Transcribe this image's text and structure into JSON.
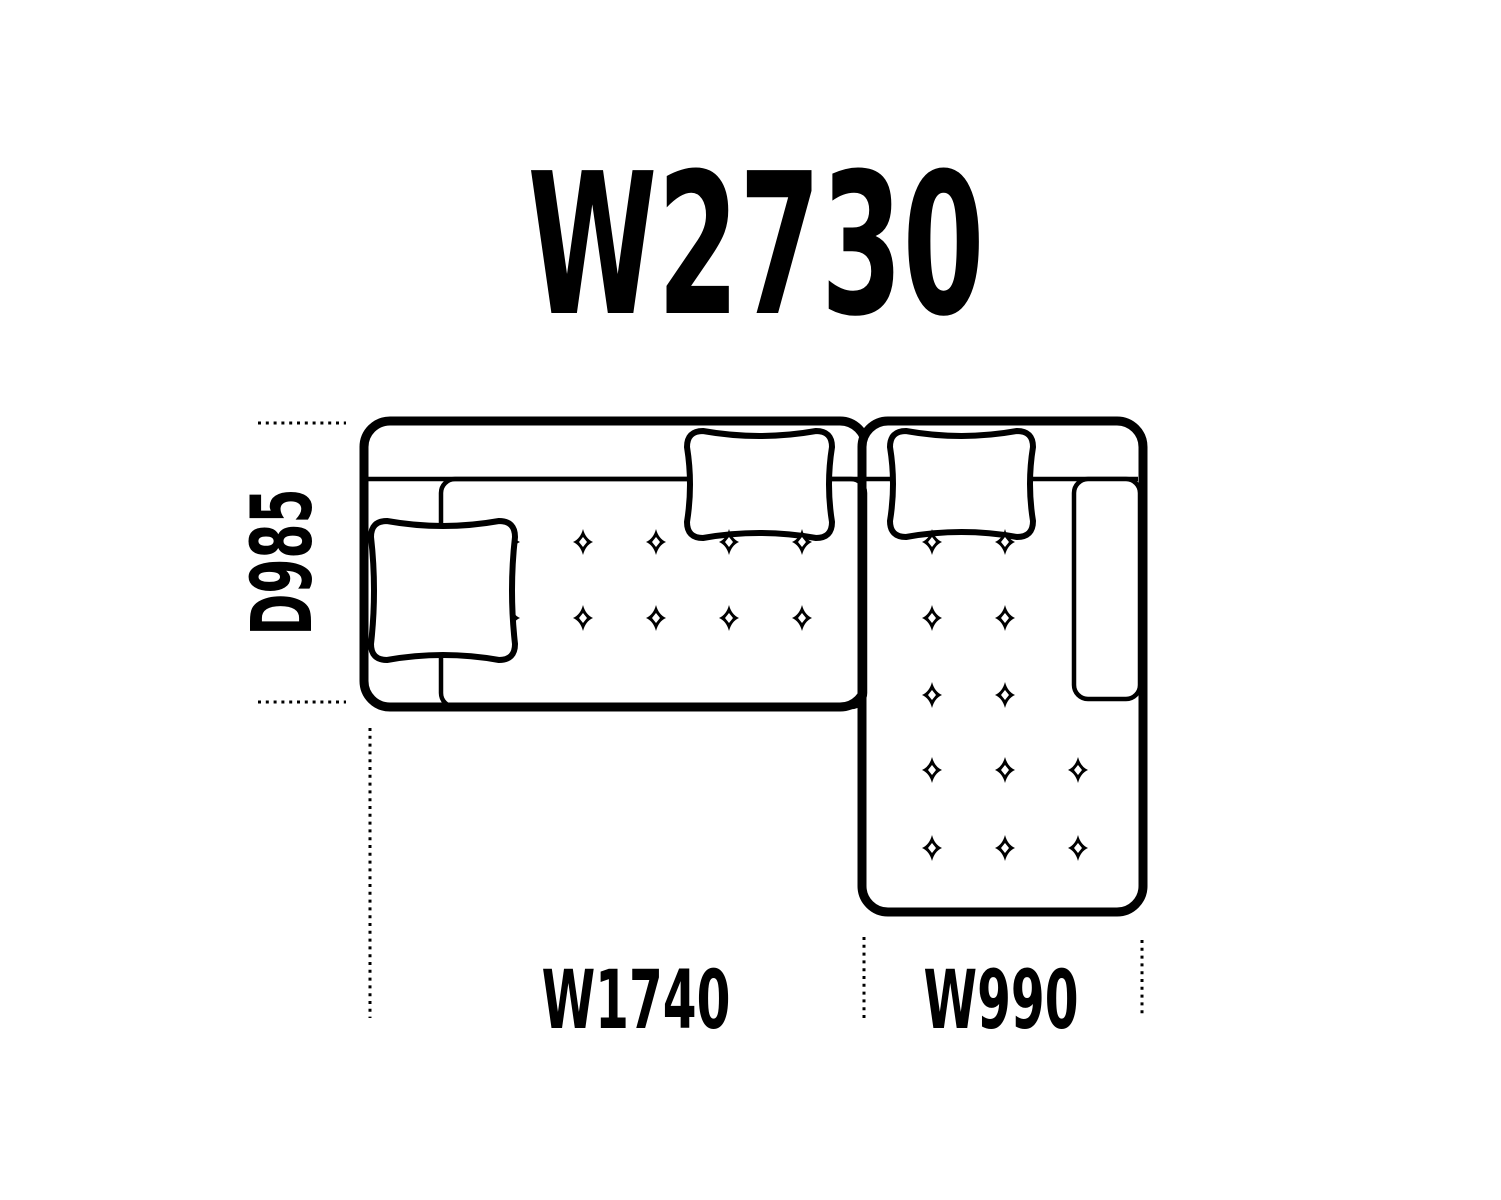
{
  "colors": {
    "background": "#ffffff",
    "ink": "#000000"
  },
  "labels": {
    "overall_width": "W2730",
    "depth": "D985",
    "left_section_width": "W1740",
    "chaise_section_width": "W990"
  }
}
